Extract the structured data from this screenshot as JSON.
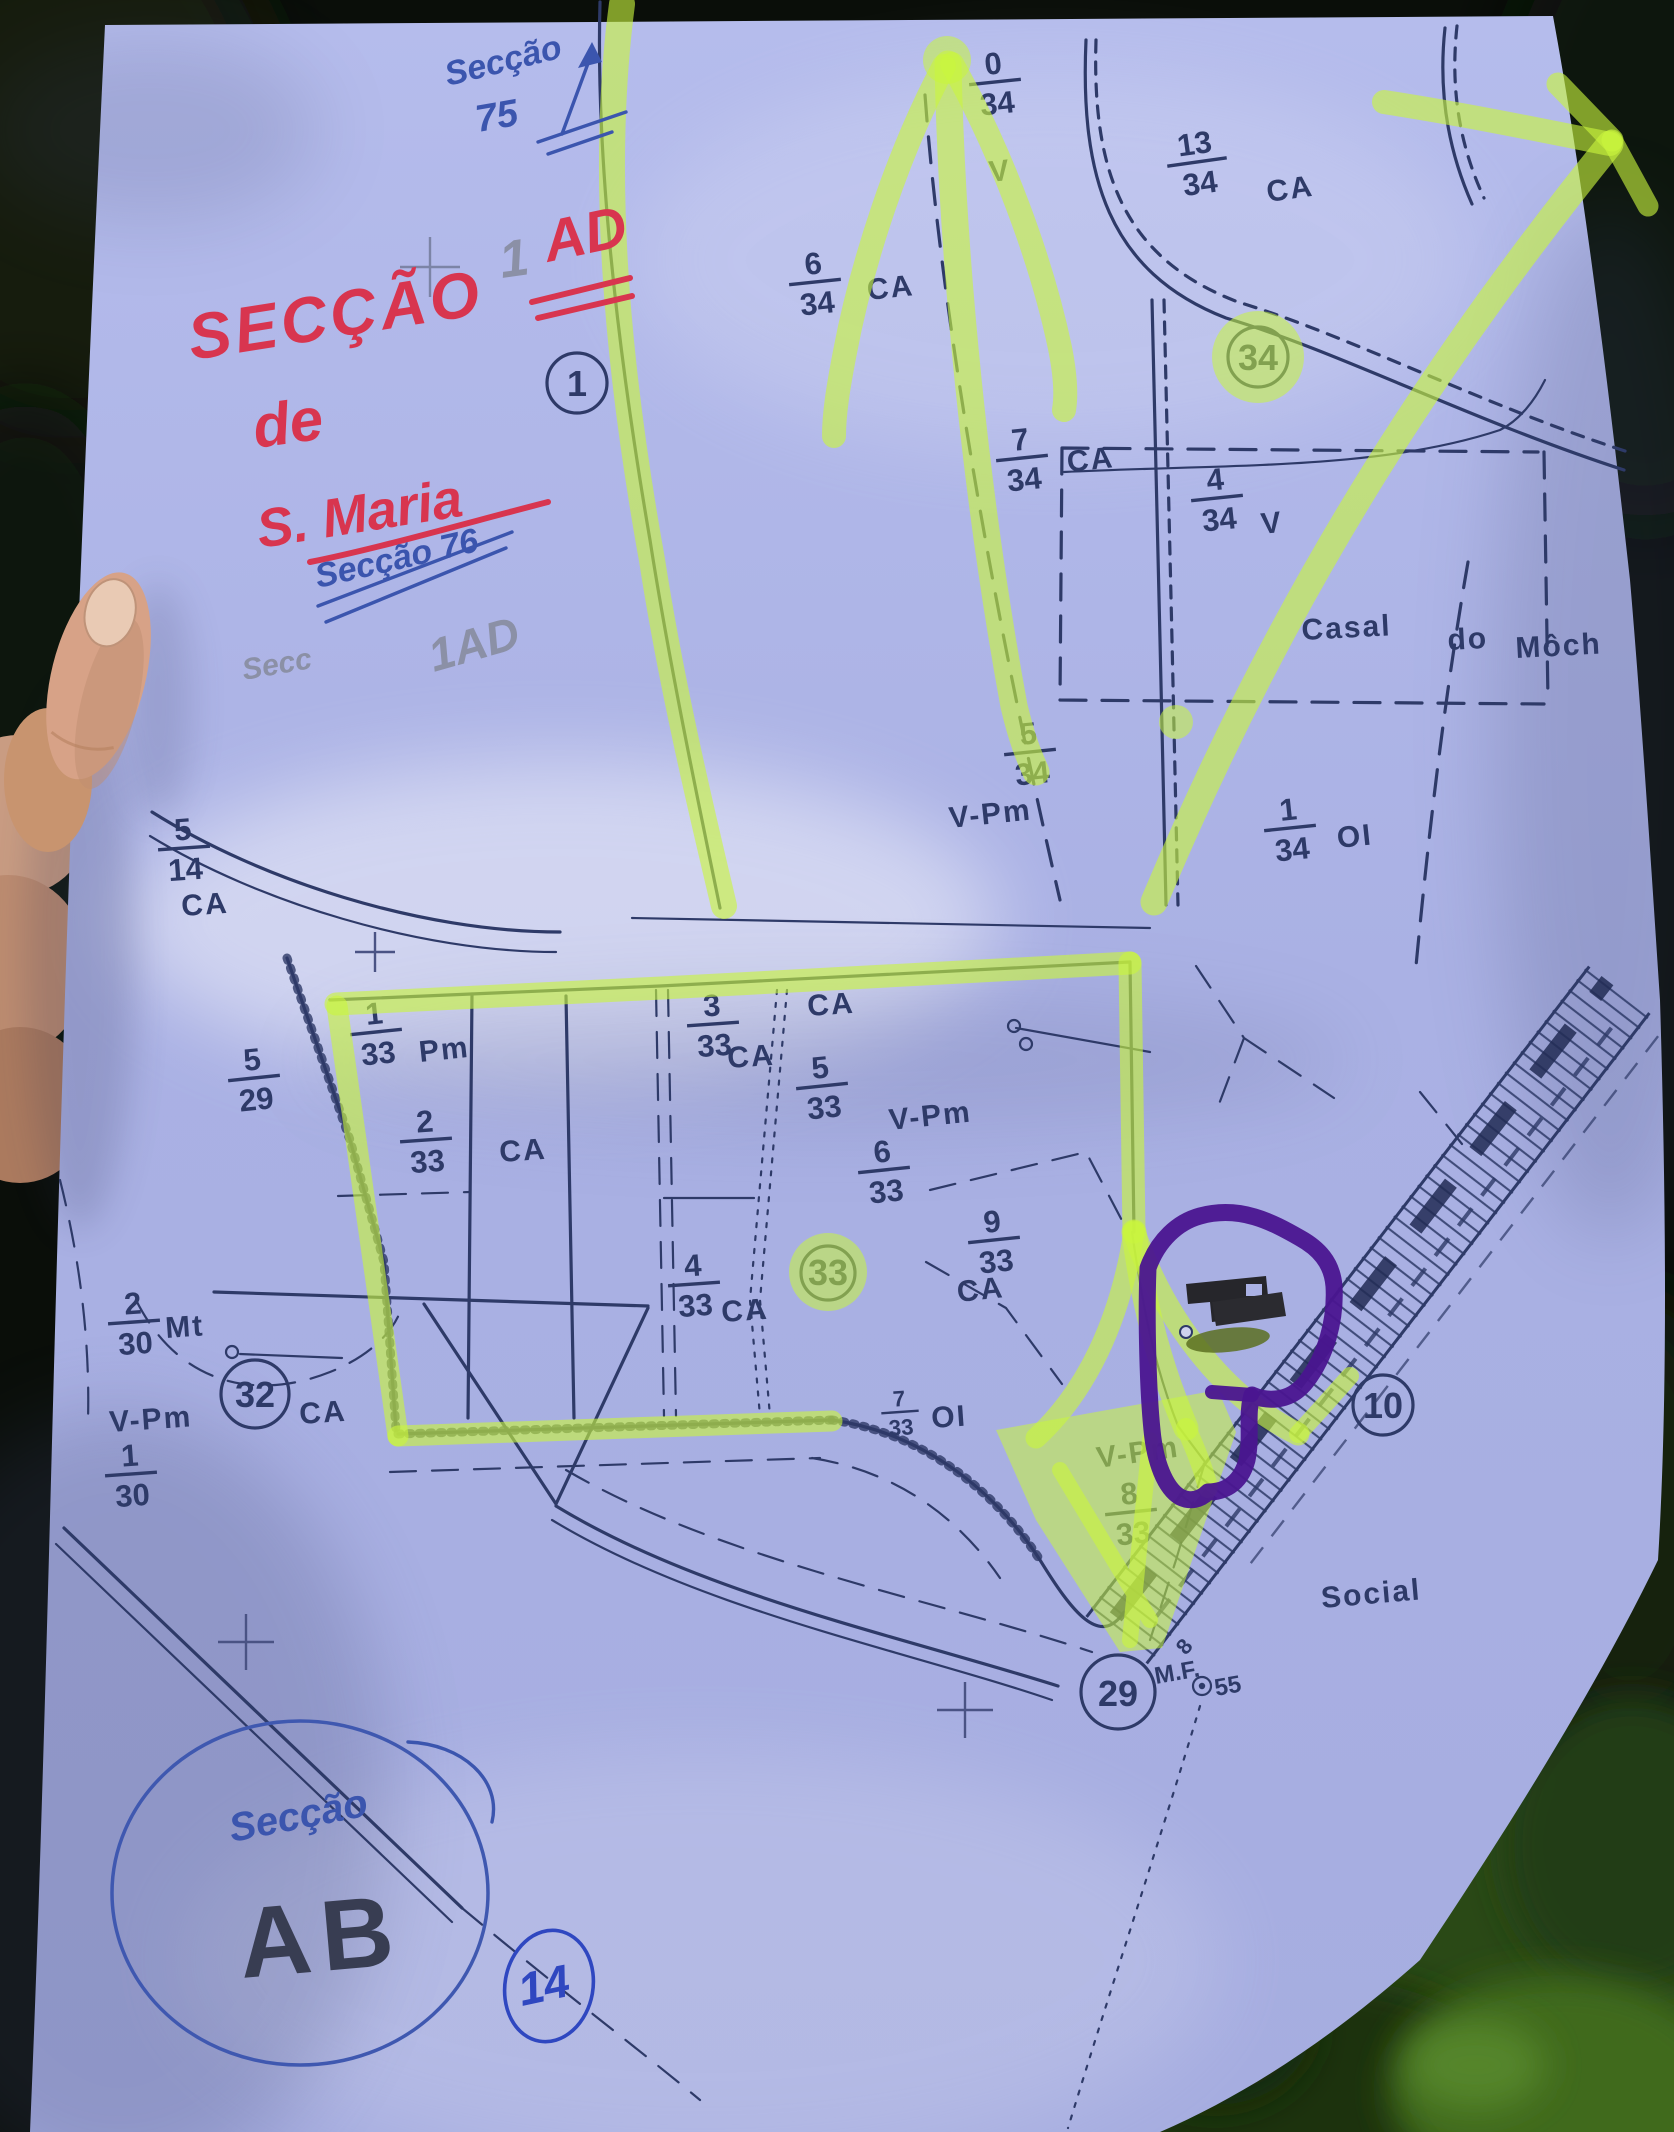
{
  "photo": {
    "subject": "hand-held paper cadastral map photographed outdoors",
    "paper_color": "#aeb5e6",
    "ink_color": "#2e3a68",
    "highlighter_color": "#c9f53d",
    "purple_marker_color": "#4a1590",
    "red_marker_color": "#d8354f",
    "blue_pen_color": "#3b55ae",
    "pencil_color": "#8b90a6"
  },
  "handwriting": {
    "top_note": "Secção",
    "top_note_num": "75",
    "title_word": "SECÇÃO",
    "title_pencil_num": "1",
    "title_suffix": "AD",
    "title_line2": "de",
    "title_line3": "S. Maria",
    "mid_note": "Secção 76",
    "pencil_note_word": "Secc",
    "pencil_note_code": "1AD",
    "bottom_circle_word": "Secção",
    "bottom_circle_code": "AB",
    "bottom_circled_number": "14"
  },
  "map": {
    "codes": {
      "ca": "CA",
      "v": "V",
      "vpm": "V-Pm",
      "pm": "Pm",
      "oi": "OI",
      "mt": "Mt"
    },
    "places": {
      "casal": "Casal",
      "do": "do",
      "moch": "Môch",
      "social": "Social"
    },
    "marks": {
      "mf": "M.F.",
      "mf_num": "55",
      "rail_num": "8"
    },
    "circled": {
      "one": "1",
      "thirtyfour": "34",
      "thirtythree": "33",
      "thirtytwo": "32",
      "ten": "10",
      "twentynine": "29"
    },
    "parcels": {
      "p0_34": {
        "num": "0",
        "den": "34"
      },
      "p6_34": {
        "num": "6",
        "den": "34"
      },
      "p13_34": {
        "num": "13",
        "den": "34"
      },
      "p7_34": {
        "num": "7",
        "den": "34"
      },
      "p4_34": {
        "num": "4",
        "den": "34"
      },
      "p5_34": {
        "num": "5",
        "den": "34"
      },
      "p1_34": {
        "num": "1",
        "den": "34"
      },
      "p5_14": {
        "num": "5",
        "den": "14"
      },
      "p5_29": {
        "num": "5",
        "den": "29"
      },
      "p1_33": {
        "num": "1",
        "den": "33"
      },
      "p2_33": {
        "num": "2",
        "den": "33"
      },
      "p3_33": {
        "num": "3",
        "den": "33"
      },
      "p5_33": {
        "num": "5",
        "den": "33"
      },
      "p6_33": {
        "num": "6",
        "den": "33"
      },
      "p9_33": {
        "num": "9",
        "den": "33"
      },
      "p4_33": {
        "num": "4",
        "den": "33"
      },
      "p2_30": {
        "num": "2",
        "den": "30"
      },
      "p1_30": {
        "num": "1",
        "den": "30"
      },
      "p7_33": {
        "num": "7",
        "den": "33"
      },
      "p8_33": {
        "num": "8",
        "den": "33"
      }
    }
  }
}
